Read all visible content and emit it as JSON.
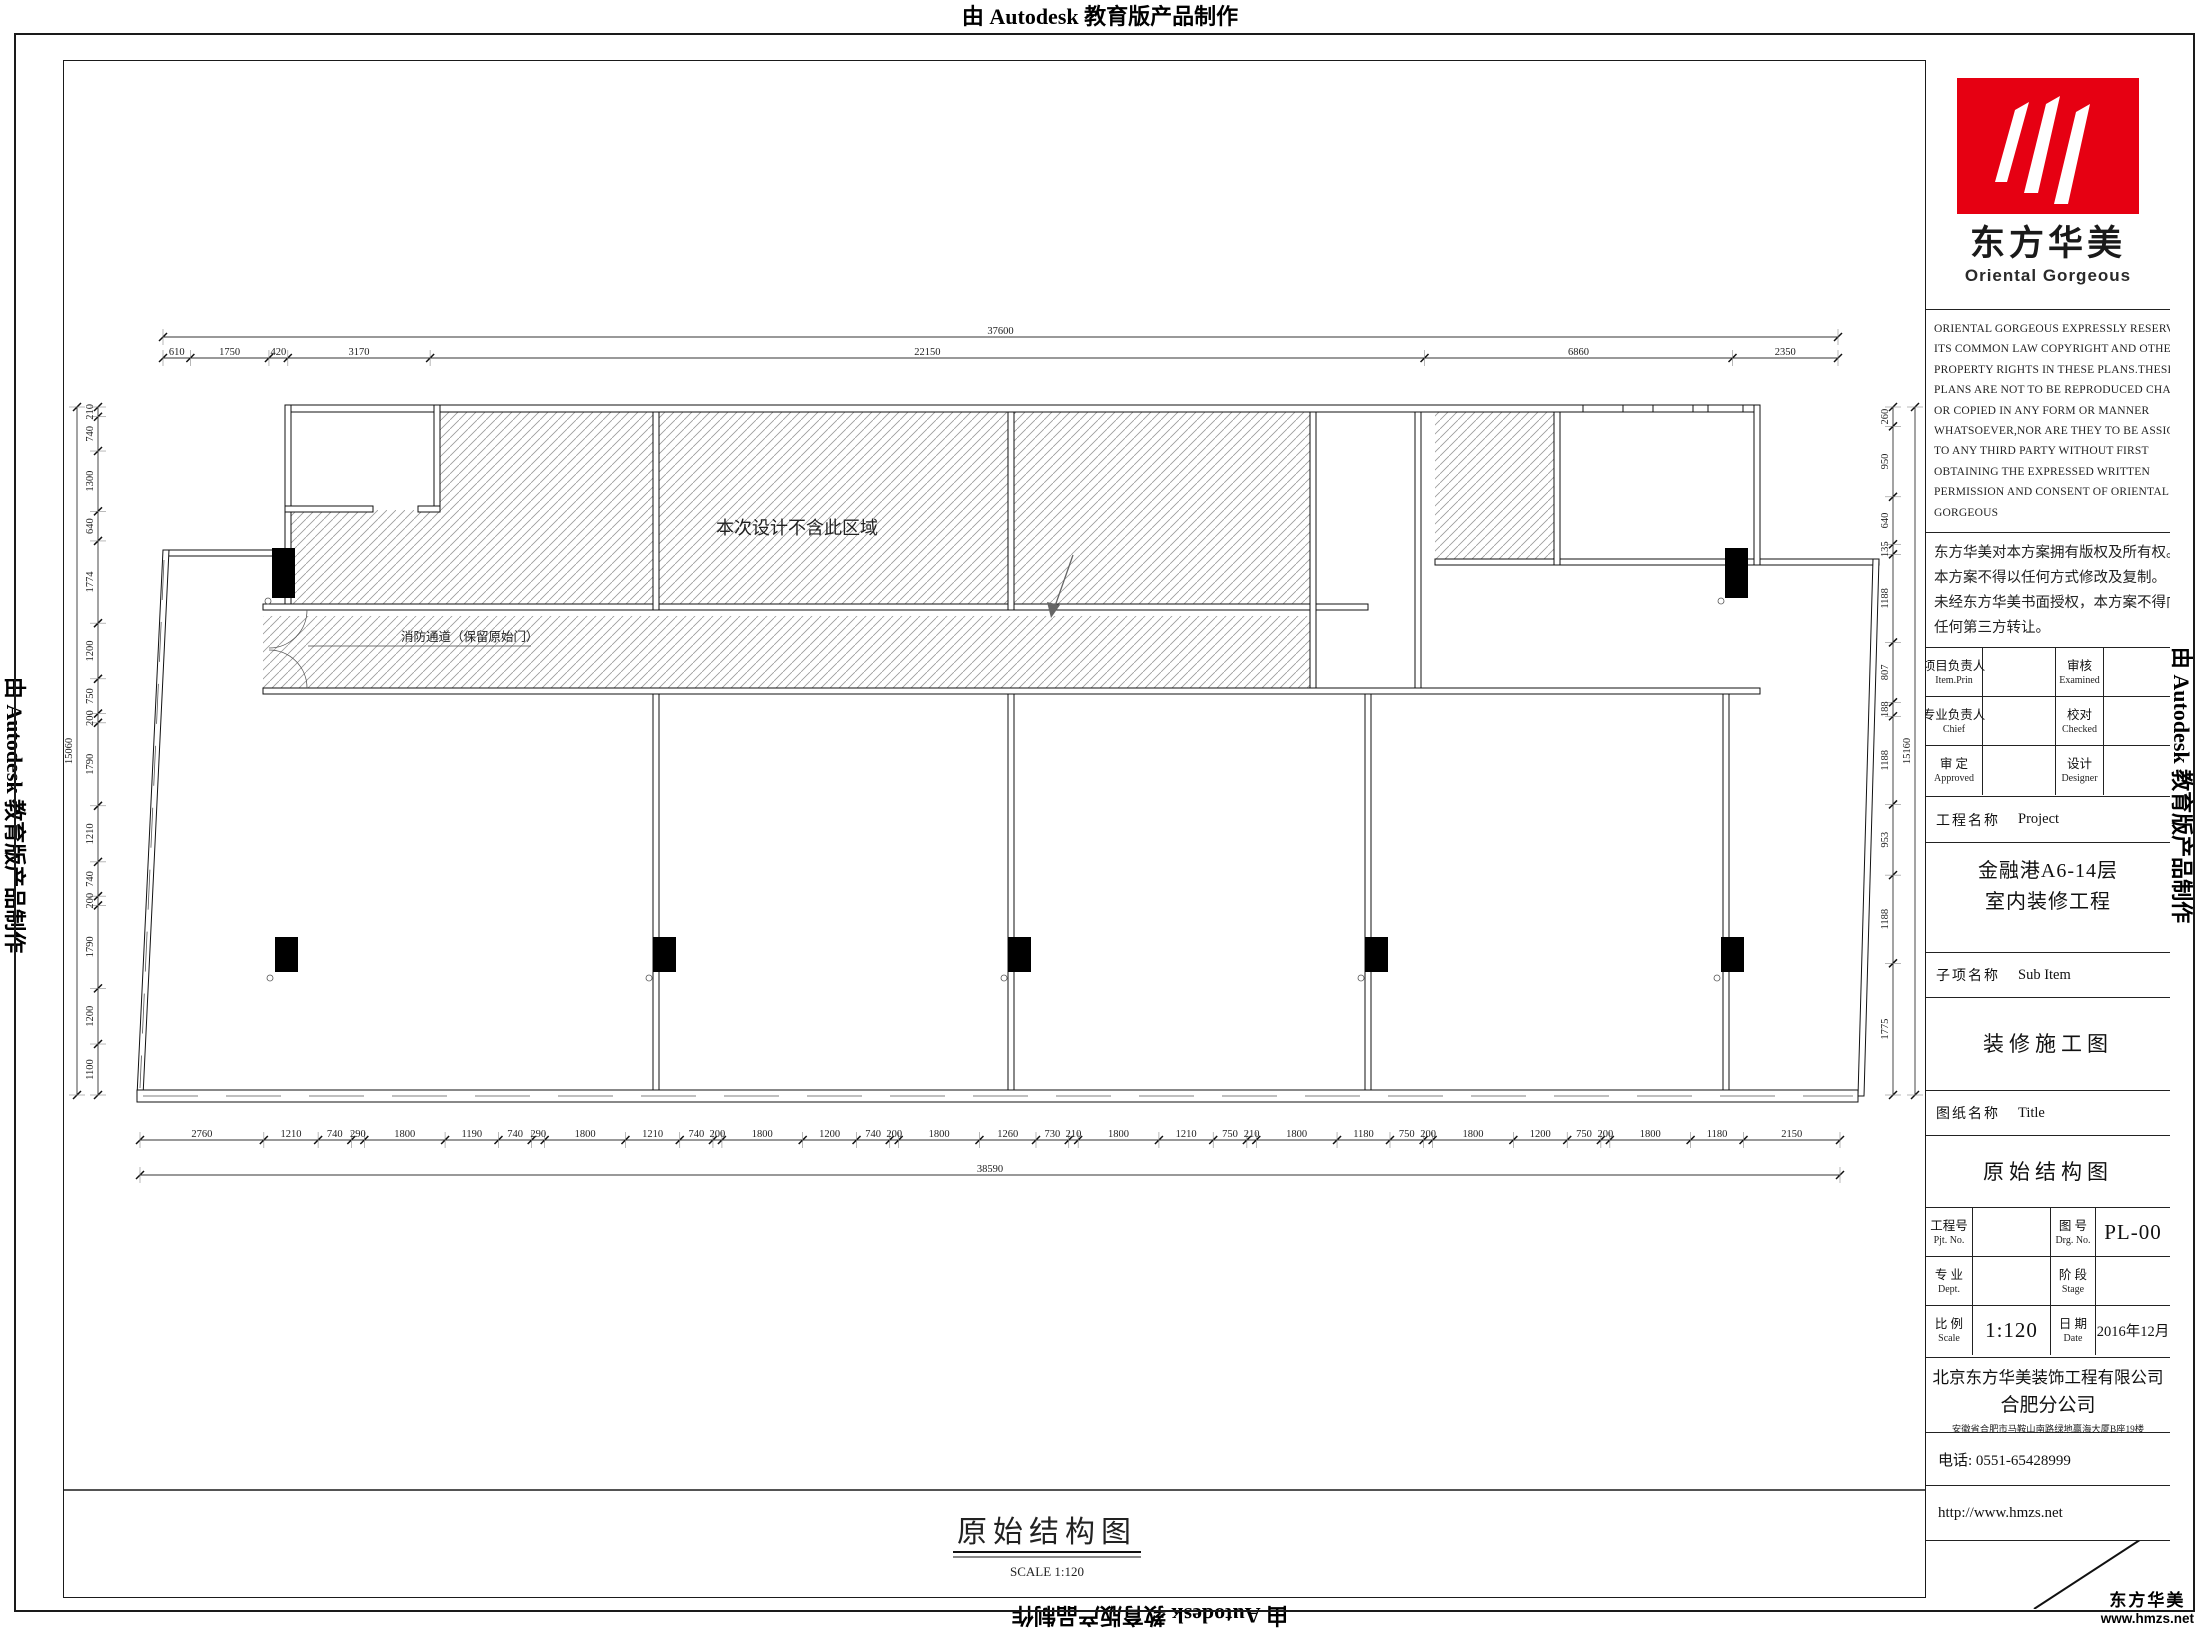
{
  "stamp": {
    "text": "由 Autodesk 教育版产品制作"
  },
  "title_block": {
    "logo": {
      "name_cn": "东方华美",
      "name_en": "Oriental Gorgeous",
      "red": "#e60012"
    },
    "copyright_en": [
      "ORIENTAL GORGEOUS EXPRESSLY RESERVES",
      "ITS COMMON LAW COPYRIGHT AND OTHER",
      "PROPERTY RIGHTS IN THESE PLANS.THESE",
      "PLANS ARE NOT TO BE REPRODUCED CHANGED",
      "OR COPIED IN ANY FORM OR MANNER",
      "WHATSOEVER,NOR ARE THEY TO BE ASSIGHED",
      "TO ANY THIRD PARTY WITHOUT FIRST",
      "OBTAINING THE EXPRESSED WRITTEN",
      "PERMISSION AND CONSENT OF ORIENTAL",
      "GORGEOUS"
    ],
    "copyright_cn": [
      "东方华美对本方案拥有版权及所有权。",
      "本方案不得以任何方式修改及复制。",
      "未经东方华美书面授权，本方案不得向",
      "任何第三方转让。"
    ],
    "personnel": [
      {
        "label_cn": "项目负责人",
        "label_en": "Item.Prin",
        "value": "",
        "label2_cn": "审核",
        "label2_en": "Examined",
        "value2": ""
      },
      {
        "label_cn": "专业负责人",
        "label_en": "Chief",
        "value": "",
        "label2_cn": "校对",
        "label2_en": "Checked",
        "value2": ""
      },
      {
        "label_cn": "审 定",
        "label_en": "Approved",
        "value": "",
        "label2_cn": "设计",
        "label2_en": "Designer",
        "value2": ""
      }
    ],
    "project": {
      "label_cn": "工程名称",
      "label_en": "Project",
      "line1": "金融港A6-14层",
      "line2": "室内装修工程"
    },
    "sub_item": {
      "label_cn": "子项名称",
      "label_en": "Sub Item",
      "value": "装修施工图"
    },
    "sheet": {
      "label_cn": "图纸名称",
      "label_en": "Title",
      "value": "原始结构图"
    },
    "info": [
      {
        "label_cn": "工程号",
        "label_en": "Pjt. No.",
        "value": "",
        "label2_cn": "图 号",
        "label2_en": "Drg. No.",
        "value2": "PL-00"
      },
      {
        "label_cn": "专 业",
        "label_en": "Dept.",
        "value": "",
        "label2_cn": "阶 段",
        "label2_en": "Stage",
        "value2": ""
      },
      {
        "label_cn": "比 例",
        "label_en": "Scale",
        "value": "1:120",
        "label2_cn": "日 期",
        "label2_en": "Date",
        "value2": "2016年12月"
      }
    ],
    "company": {
      "line1": "北京东方华美装饰工程有限公司",
      "line2": "合肥分公司",
      "address": "安徽省合肥市马鞍山南路绿地赢海大厦B座19楼"
    },
    "phone": "电话: 0551-65428999",
    "website": "http://www.hmzs.net"
  },
  "plan": {
    "excluded_area_note": "本次设计不含此区域",
    "corridor_note": "消防通道（保留原始门）",
    "title": "原始结构图",
    "scale_note": "SCALE  1:120",
    "dims": {
      "top": {
        "overall": "37600",
        "segments": [
          610,
          1750,
          420,
          3170,
          22150,
          6860,
          2350
        ]
      },
      "bottom": {
        "overall": "38590",
        "segments": [
          2760,
          1210,
          740,
          290,
          1800,
          1190,
          740,
          290,
          1800,
          1210,
          740,
          200,
          1800,
          1200,
          740,
          200,
          1800,
          1260,
          730,
          210,
          1800,
          1210,
          750,
          210,
          1800,
          1180,
          750,
          200,
          1800,
          1200,
          750,
          200,
          1800,
          1180,
          2150
        ]
      },
      "left": {
        "overall": "15060",
        "segments": [
          210,
          740,
          1300,
          640,
          1774,
          1200,
          750,
          200,
          1790,
          1210,
          740,
          200,
          1790,
          1200,
          1100
        ]
      },
      "right": {
        "overall": "15160",
        "segments": [
          260,
          950,
          640,
          135,
          1188,
          807,
          188,
          1188,
          953,
          1188,
          1775
        ]
      }
    }
  },
  "footer": {
    "brand": "东方华美",
    "url": "www.hmzs.net"
  }
}
